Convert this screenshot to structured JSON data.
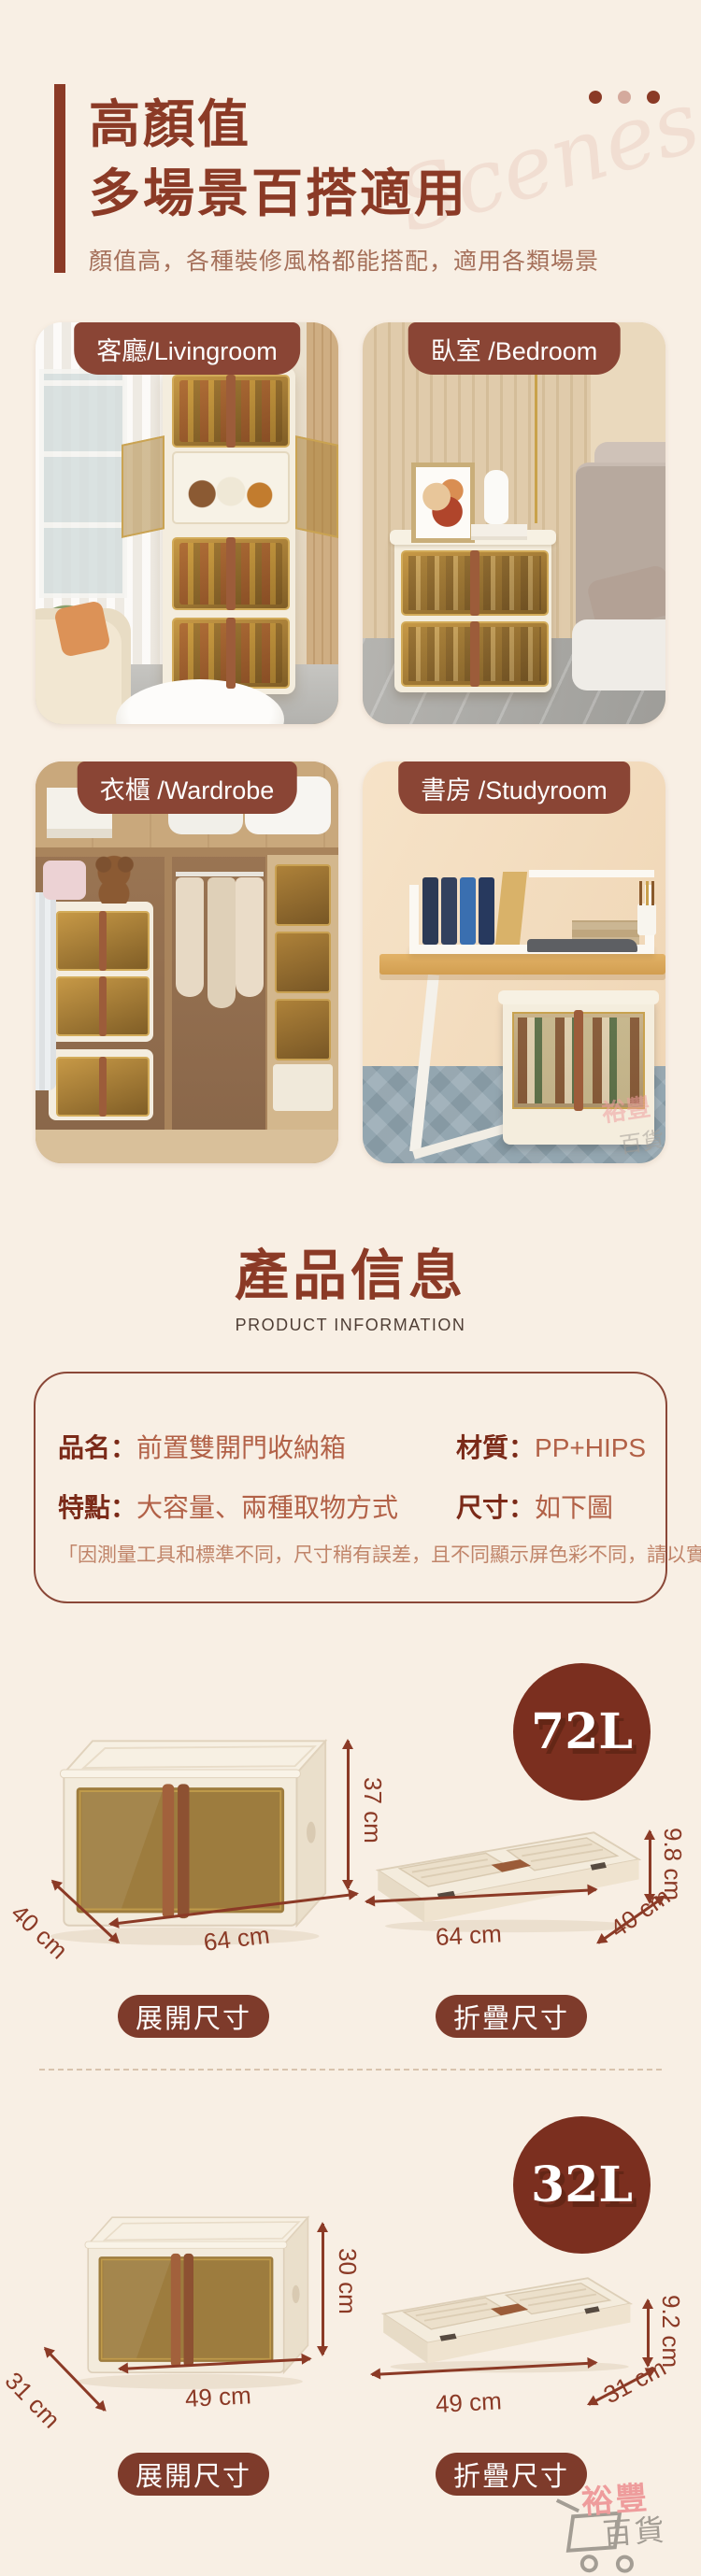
{
  "palette": {
    "background": "#f8efe4",
    "accent_red": "#8b3a26",
    "badge_brown": "#8a4535",
    "circle_brown": "#7b2f1f",
    "pill_brown": "#7e3b2b",
    "amber_door": "#916c28"
  },
  "header": {
    "title_line1": "高顏值",
    "title_line2": "多場景百搭適用",
    "subtitle": "顏值高，各種裝修風格都能搭配，適用各類場景",
    "watermark": "Scenes"
  },
  "scene_cards": [
    {
      "label": "客廳/Livingroom"
    },
    {
      "label": "臥室 /Bedroom"
    },
    {
      "label": "衣櫃 /Wardrobe"
    },
    {
      "label": "書房 /Studyroom"
    }
  ],
  "product_info": {
    "title": "產品信息",
    "subtitle": "PRODUCT INFORMATION",
    "fields": [
      {
        "label": "品名：",
        "value": "前置雙開門收納箱"
      },
      {
        "label": "材質：",
        "value": "PP+HIPS"
      },
      {
        "label": "特點：",
        "value": "大容量、兩種取物方式"
      },
      {
        "label": "尺寸：",
        "value": "如下圖"
      }
    ],
    "disclaimer": "「因測量工具和標準不同，尺寸稍有誤差，且不同顯示屏色彩不同，請以實物為準哦"
  },
  "sizes": [
    {
      "volume": "72L",
      "expanded_caption": "展開尺寸",
      "folded_caption": "折疊尺寸",
      "exp_h": "37 cm",
      "exp_d": "40 cm",
      "exp_w": "64 cm",
      "fold_h": "9.8 cm",
      "fold_w": "64 cm",
      "fold_d": "40 cm"
    },
    {
      "volume": "32L",
      "expanded_caption": "展開尺寸",
      "folded_caption": "折疊尺寸",
      "exp_h": "30 cm",
      "exp_d": "31 cm",
      "exp_w": "49 cm",
      "fold_h": "9.2 cm",
      "fold_w": "49 cm",
      "fold_d": "31 cm"
    }
  ],
  "brand": {
    "line1": "裕豐",
    "line2": "百貨"
  }
}
